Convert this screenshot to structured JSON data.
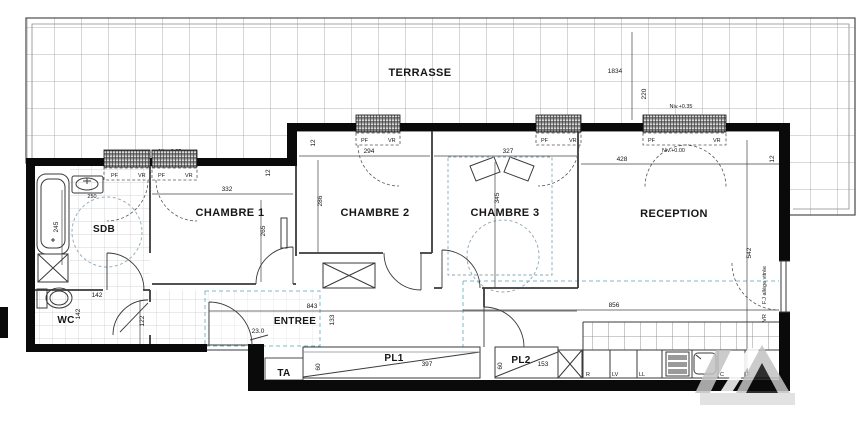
{
  "rooms": {
    "terrasse": "TERRASSE",
    "chambre1": "CHAMBRE 1",
    "chambre2": "CHAMBRE 2",
    "chambre3": "CHAMBRE 3",
    "reception": "RECEPTION",
    "sdb": "SDB",
    "wc": "WC",
    "entree": "ENTREE",
    "pl1": "PL1",
    "pl2": "PL2",
    "ta": "TA"
  },
  "levels": {
    "terrace": "Niv.+0.35",
    "interior": "Niv.+0.00"
  },
  "win": {
    "pf": "PF",
    "vr": "VR",
    "east_glazing": "F.J allège vitrée",
    "east_vr": "VR"
  },
  "kitchen": {
    "fridge": "R",
    "dishwasher": "LV",
    "washer": "LL",
    "cooktop": "C",
    "oven": "F"
  },
  "dims": {
    "terrace_length": "1834",
    "terrace_depth": "220",
    "ch1_width": "332",
    "ch1_depth": "265",
    "ch2_width": "294",
    "ch2_depth": "286",
    "ch3_width": "327",
    "ch3_depth": "345",
    "reception_width": "428",
    "reception_depth": "542",
    "reception_length": "856",
    "entree_length": "843",
    "entree_width": "133",
    "sdb_depth": "245",
    "sdb_sink": "250",
    "wc_width": "142",
    "wc_depth": "142",
    "wc_passage": "122",
    "pl1_width": "397",
    "pl1_depth": "60",
    "pl2_width": "153",
    "pl2_depth": "60",
    "wall_thickness": "12",
    "step_note": "23.0"
  },
  "colors": {
    "wall": "#0a0a0a",
    "terrace_grid": "#9a9a9a",
    "teal_dash": "#7fb8c4",
    "watermark": "#c2c2c2"
  }
}
